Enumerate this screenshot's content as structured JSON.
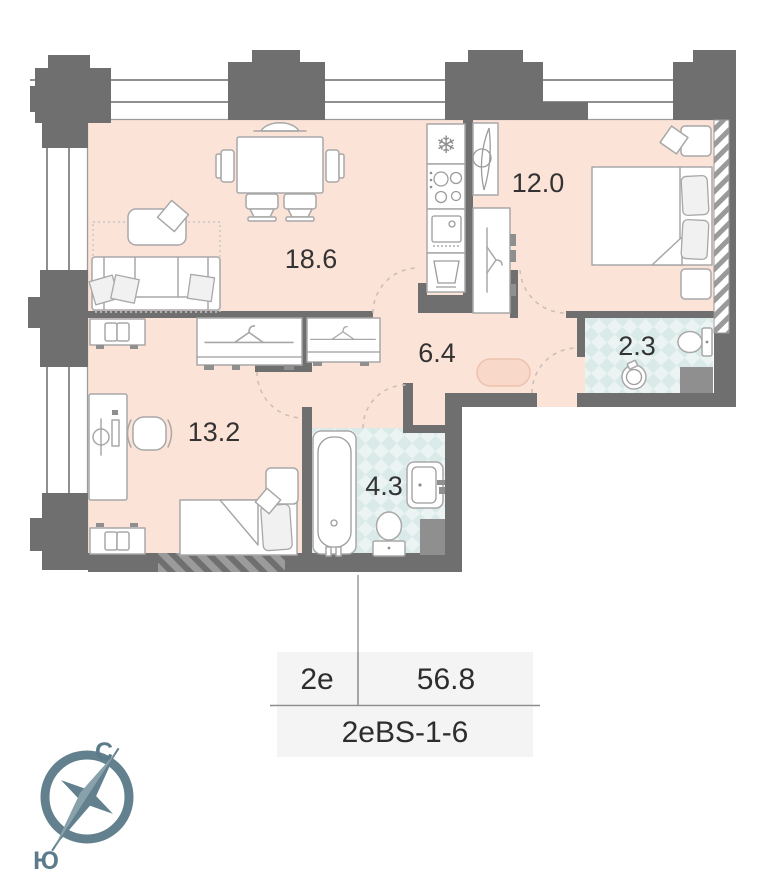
{
  "rooms": {
    "living": {
      "name": "living-dining",
      "area": "18.6"
    },
    "bedroom": {
      "name": "bedroom",
      "area": "12.0"
    },
    "wc": {
      "name": "wc-small",
      "area": "2.3"
    },
    "hall": {
      "name": "hallway",
      "area": "6.4"
    },
    "bedroom2": {
      "name": "bedroom-2",
      "area": "13.2"
    },
    "bath": {
      "name": "bathroom",
      "area": "4.3"
    }
  },
  "info": {
    "type": "2e",
    "total_area": "56.8",
    "plan_code": "2eBS-1-6"
  },
  "compass": {
    "north_label": "С",
    "south_label": "Ю"
  },
  "icons": {
    "fridge_snowflake": "❄"
  },
  "colors": {
    "room_fill": "#fce3d8",
    "wet_room_fill": "#e7f2f1",
    "wall": "#6f6f6f",
    "compass_slate": "#63808e",
    "table_bg": "#f4f4f4"
  }
}
